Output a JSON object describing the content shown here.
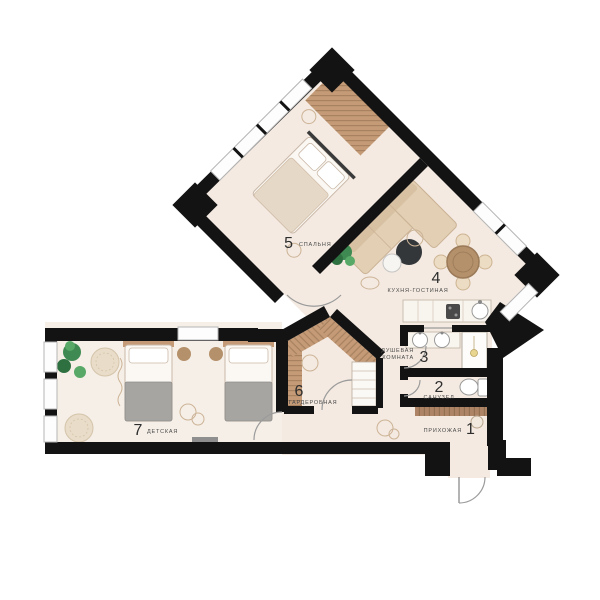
{
  "colors": {
    "wall": "#131313",
    "floor": "#f4eae1",
    "floor_light": "#f6efe7",
    "wood": "#c59b77",
    "wood_dark": "#ad8566",
    "wood_table": "#b4906b",
    "charcoal": "#33373a",
    "green": "#3e8a52",
    "green_dark": "#2e7040",
    "green_light": "#58a967",
    "blanket_gray": "#a7a5a2",
    "beige": "#e2cfb4",
    "beige_dark": "#cbb295",
    "white_fixture": "#fdfcfa",
    "line_gray": "#9a9a9a",
    "window_frame": "#b5b5b5",
    "doodle": "#ccb396",
    "label_number": "#2e2e2e",
    "label_name": "#4a4a4a"
  },
  "rooms": {
    "hallway": {
      "number": "1",
      "name": "ПРИХОЖАЯ"
    },
    "bathroom": {
      "number": "2",
      "name": "САНУЗЕЛ"
    },
    "shower": {
      "number": "3",
      "name_line1": "ДУШЕВАЯ",
      "name_line2": "КОМНАТА"
    },
    "kitchen": {
      "number": "4",
      "name": "КУХНЯ-ГОСТИНАЯ"
    },
    "bedroom": {
      "number": "5",
      "name": "СПАЛЬНЯ"
    },
    "wardrobe": {
      "number": "6",
      "name": "ГАРДЕРОБНАЯ"
    },
    "kids": {
      "number": "7",
      "name": "ДЕТСКАЯ"
    }
  }
}
